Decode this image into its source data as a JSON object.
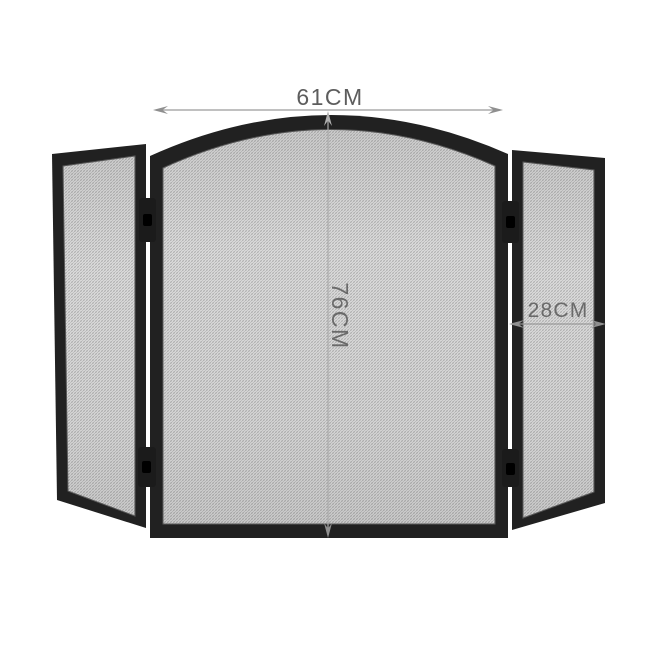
{
  "illustration": {
    "subject": "three-panel-mesh-fire-screen"
  },
  "dimensions": {
    "width_label": "61CM",
    "height_label": "76CM",
    "side_panel_label": "28CM"
  },
  "colors": {
    "background": "#ffffff",
    "frame": "#212121",
    "hinge": "#1b1b1b",
    "mesh_base": "#ececec",
    "mesh_weave_dark": "#aaaaaa",
    "mesh_weave_light": "#c6c6c6",
    "mesh_inner_lip": "#5a5a5a",
    "dimension_line": "#9b9b9b",
    "dimension_arrow": "#8f8f8f",
    "dimension_text": "#5d5d5d",
    "dimension_text_on_mesh": "#6a6a6a"
  }
}
